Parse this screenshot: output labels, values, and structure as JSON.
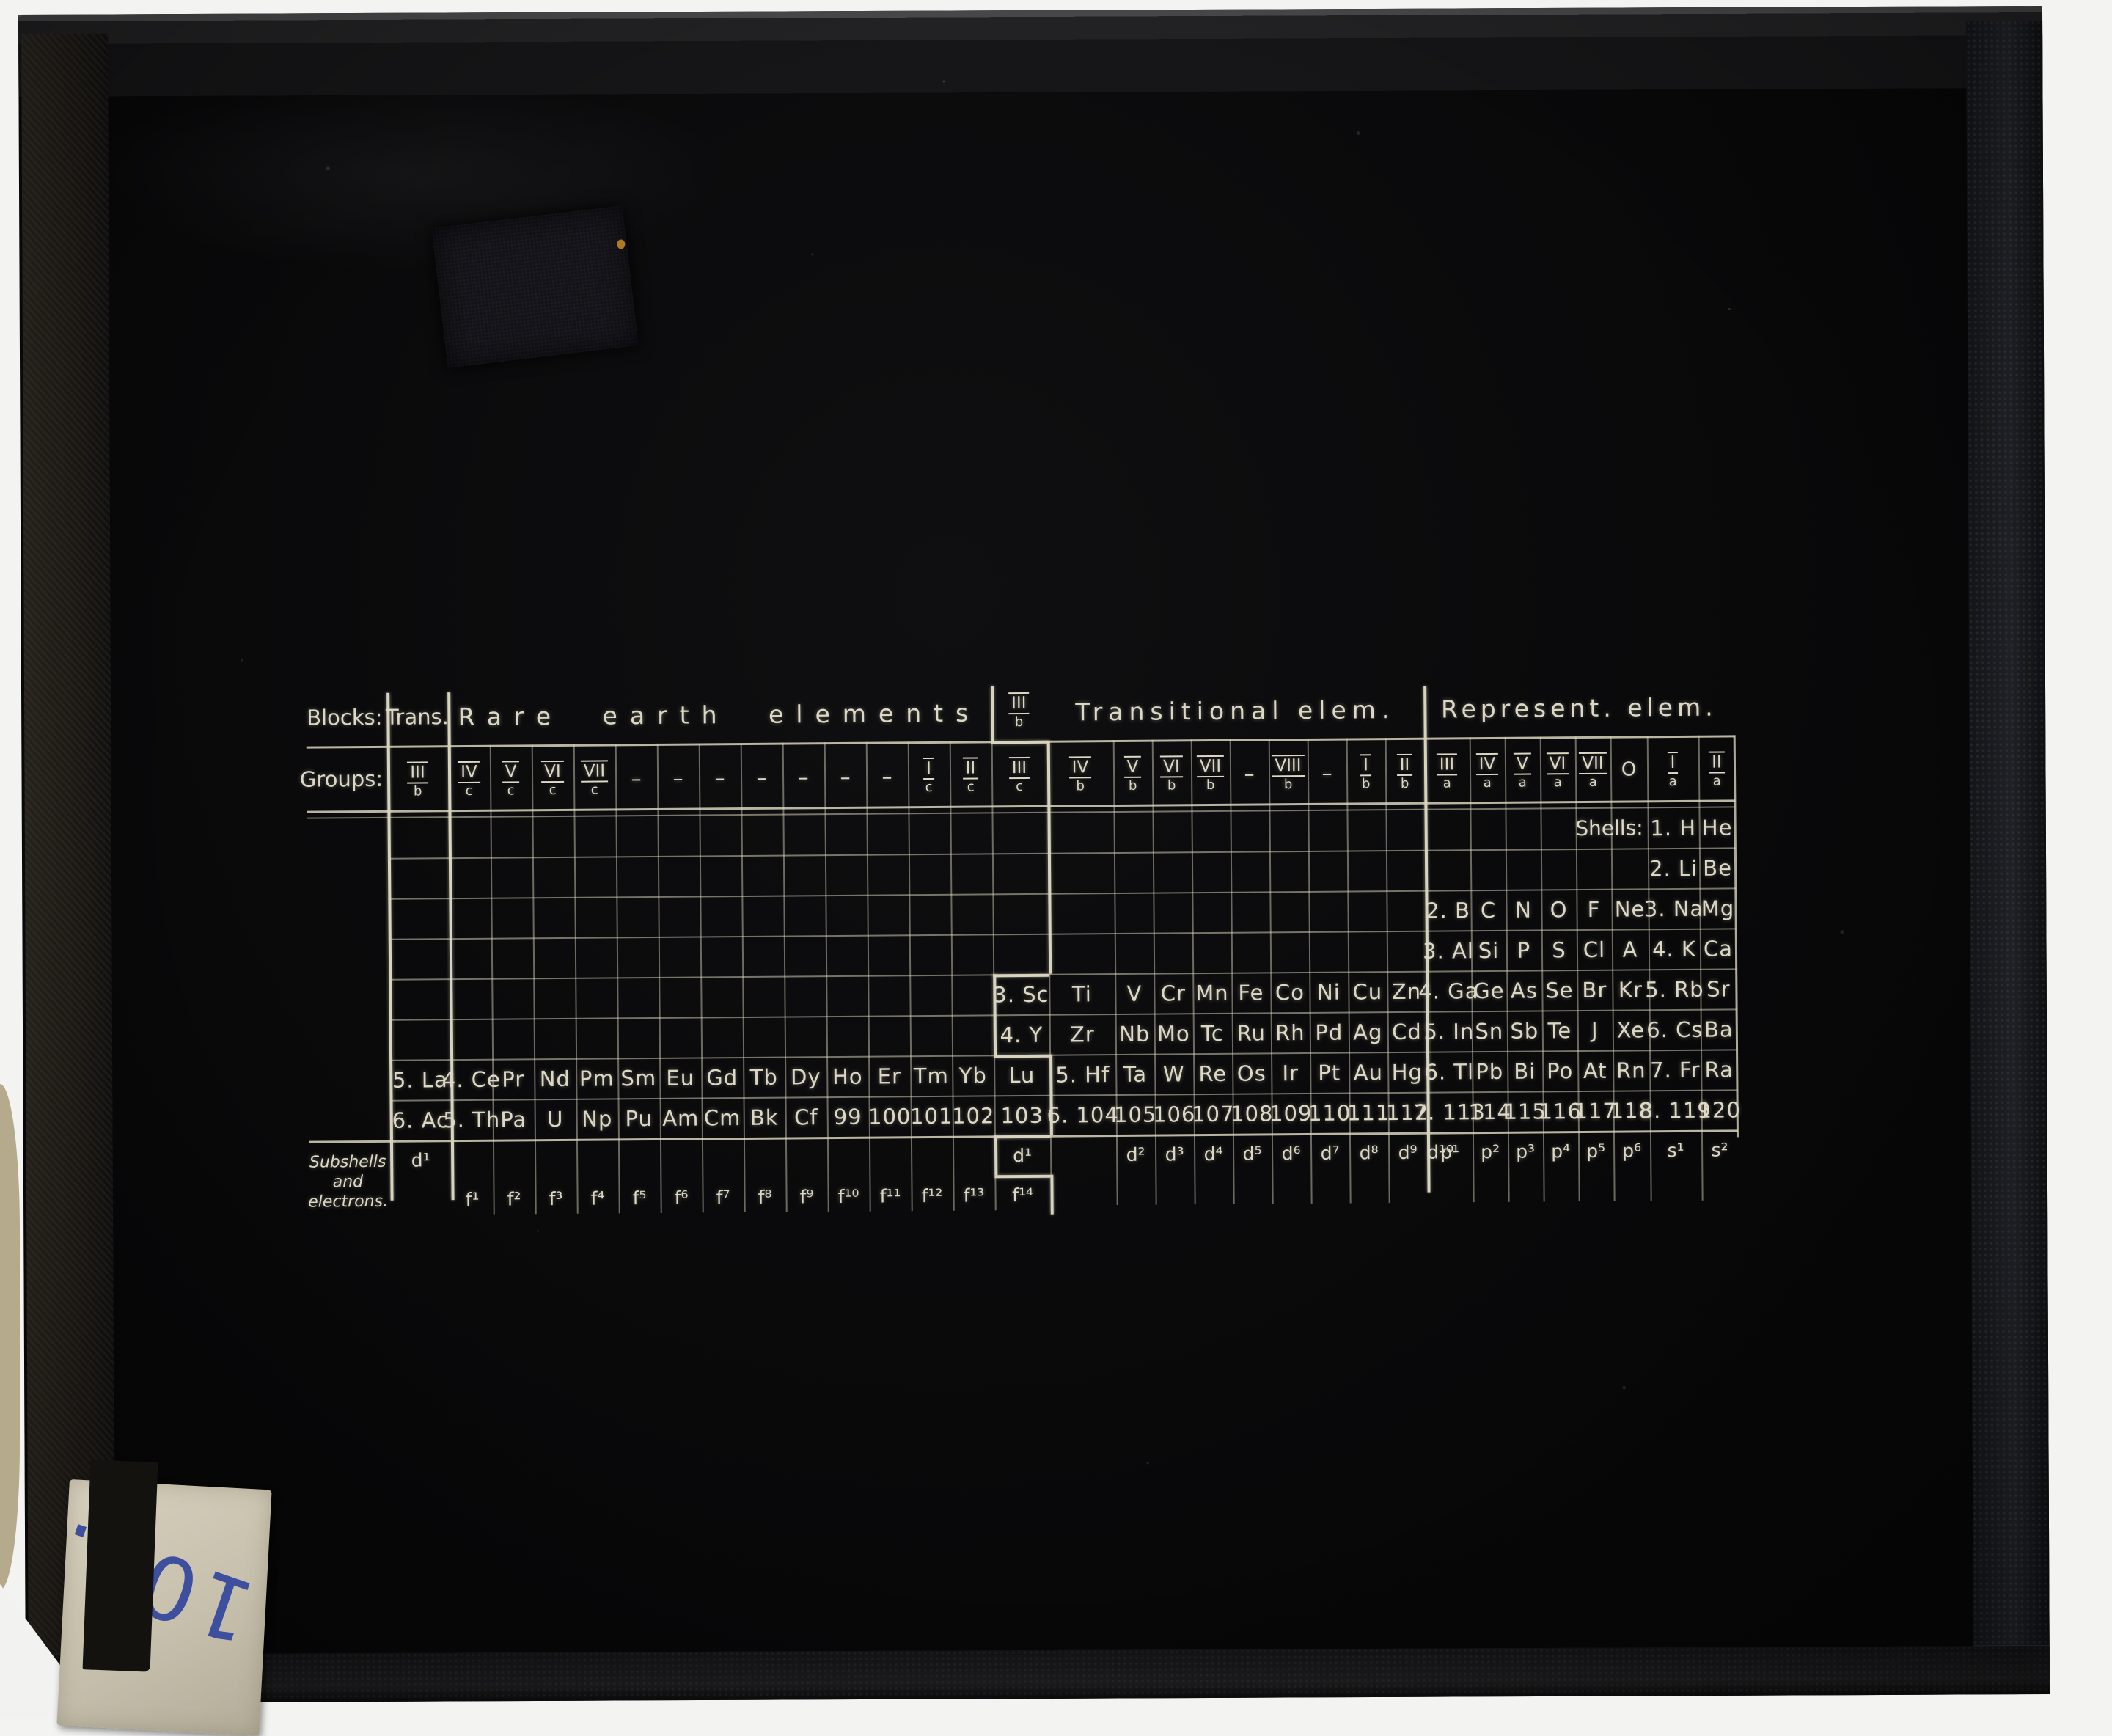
{
  "photo": {
    "sticker_number": "103."
  },
  "colors": {
    "table_ink": "#ddd8c5",
    "grid_line": "#d8d3bd",
    "sticker_ink": "#3d4f9e"
  },
  "table": {
    "header": {
      "blocks_label": "Blocks:",
      "trans": "Trans.",
      "rare": "Rare earth elements",
      "lu_block": {
        "n": "III",
        "l": "b"
      },
      "transitional": "Transitional elem.",
      "represent": "Represent. elem."
    },
    "groups_label": "Groups:",
    "groups": {
      "trans": {
        "n": "III",
        "l": "b"
      },
      "re": [
        {
          "n": "IV",
          "l": "c"
        },
        {
          "n": "V",
          "l": "c"
        },
        {
          "n": "VI",
          "l": "c"
        },
        {
          "n": "VII",
          "l": "c"
        },
        {
          "n": "–",
          "l": ""
        },
        {
          "n": "–",
          "l": ""
        },
        {
          "n": "–",
          "l": ""
        },
        {
          "n": "–",
          "l": ""
        },
        {
          "n": "–",
          "l": ""
        },
        {
          "n": "–",
          "l": ""
        },
        {
          "n": "–",
          "l": ""
        },
        {
          "n": "I",
          "l": "c"
        },
        {
          "n": "II",
          "l": "c"
        }
      ],
      "lu": {
        "n": "III",
        "l": "c"
      },
      "tr": [
        {
          "n": "IV",
          "l": "b"
        },
        {
          "n": "V",
          "l": "b"
        },
        {
          "n": "VI",
          "l": "b"
        },
        {
          "n": "VII",
          "l": "b"
        },
        {
          "n": "–",
          "l": ""
        },
        {
          "n": "VIII",
          "l": "b"
        },
        {
          "n": "–",
          "l": ""
        },
        {
          "n": "I",
          "l": "b"
        },
        {
          "n": "II",
          "l": "b"
        }
      ],
      "rp": [
        {
          "n": "III",
          "l": "a"
        },
        {
          "n": "IV",
          "l": "a"
        },
        {
          "n": "V",
          "l": "a"
        },
        {
          "n": "VI",
          "l": "a"
        },
        {
          "n": "VII",
          "l": "a"
        },
        {
          "n": "O",
          "l": ""
        },
        {
          "n": "I",
          "l": "a"
        },
        {
          "n": "II",
          "l": "a"
        }
      ]
    },
    "shells_label": "Shells:",
    "rows": [
      {
        "rp": [
          "",
          "",
          "",
          "",
          "",
          "",
          "1. H",
          "He"
        ]
      },
      {
        "rp": [
          "",
          "",
          "",
          "",
          "",
          "",
          "2. Li",
          "Be"
        ]
      },
      {
        "rp": [
          "2. B",
          "C",
          "N",
          "O",
          "F",
          "Ne",
          "3. Na",
          "Mg"
        ]
      },
      {
        "rp": [
          "3. Al",
          "Si",
          "P",
          "S",
          "Cl",
          "A",
          "4. K",
          "Ca"
        ]
      },
      {
        "lu": "3. Sc",
        "tr": [
          "Ti",
          "V",
          "Cr",
          "Mn",
          "Fe",
          "Co",
          "Ni",
          "Cu",
          "Zn"
        ],
        "rp": [
          "4. Ga",
          "Ge",
          "As",
          "Se",
          "Br",
          "Kr",
          "5. Rb",
          "Sr"
        ]
      },
      {
        "lu": "4. Y",
        "tr": [
          "Zr",
          "Nb",
          "Mo",
          "Tc",
          "Ru",
          "Rh",
          "Pd",
          "Ag",
          "Cd"
        ],
        "rp": [
          "5. In",
          "Sn",
          "Sb",
          "Te",
          "J",
          "Xe",
          "6. Cs",
          "Ba"
        ]
      },
      {
        "trans": "5. La",
        "re": [
          "4. Ce",
          "Pr",
          "Nd",
          "Pm",
          "Sm",
          "Eu",
          "Gd",
          "Tb",
          "Dy",
          "Ho",
          "Er",
          "Tm",
          "Yb"
        ],
        "lu": "Lu",
        "tr": [
          "5. Hf",
          "Ta",
          "W",
          "Re",
          "Os",
          "Ir",
          "Pt",
          "Au",
          "Hg"
        ],
        "rp": [
          "6. Tl",
          "Pb",
          "Bi",
          "Po",
          "At",
          "Rn",
          "7. Fr",
          "Ra"
        ]
      },
      {
        "trans": "6. Ac",
        "re": [
          "5. Th",
          "Pa",
          "U",
          "Np",
          "Pu",
          "Am",
          "Cm",
          "Bk",
          "Cf",
          "99",
          "100",
          "101",
          "102"
        ],
        "lu": "103",
        "tr": [
          "6. 104",
          "105",
          "106",
          "107",
          "108",
          "109",
          "110",
          "111",
          "112"
        ],
        "rp": [
          "7. 113",
          "114",
          "115",
          "116",
          "117",
          "118",
          "8. 119",
          "120"
        ]
      }
    ],
    "subshells": {
      "label_lines": [
        "Subshells",
        "and",
        "electrons."
      ],
      "trans_d": "d¹",
      "lu_d": "d¹",
      "lu_f": "f¹⁴",
      "re_f": [
        "f¹",
        "f²",
        "f³",
        "f⁴",
        "f⁵",
        "f⁶",
        "f⁷",
        "f⁸",
        "f⁹",
        "f¹⁰",
        "f¹¹",
        "f¹²",
        "f¹³"
      ],
      "tr_d": [
        "d²",
        "d³",
        "d⁴",
        "d⁵",
        "d⁶",
        "d⁷",
        "d⁸",
        "d⁹",
        "d¹⁰"
      ],
      "rp": [
        "p¹",
        "p²",
        "p³",
        "p⁴",
        "p⁵",
        "p⁶",
        "s¹",
        "s²"
      ]
    }
  }
}
